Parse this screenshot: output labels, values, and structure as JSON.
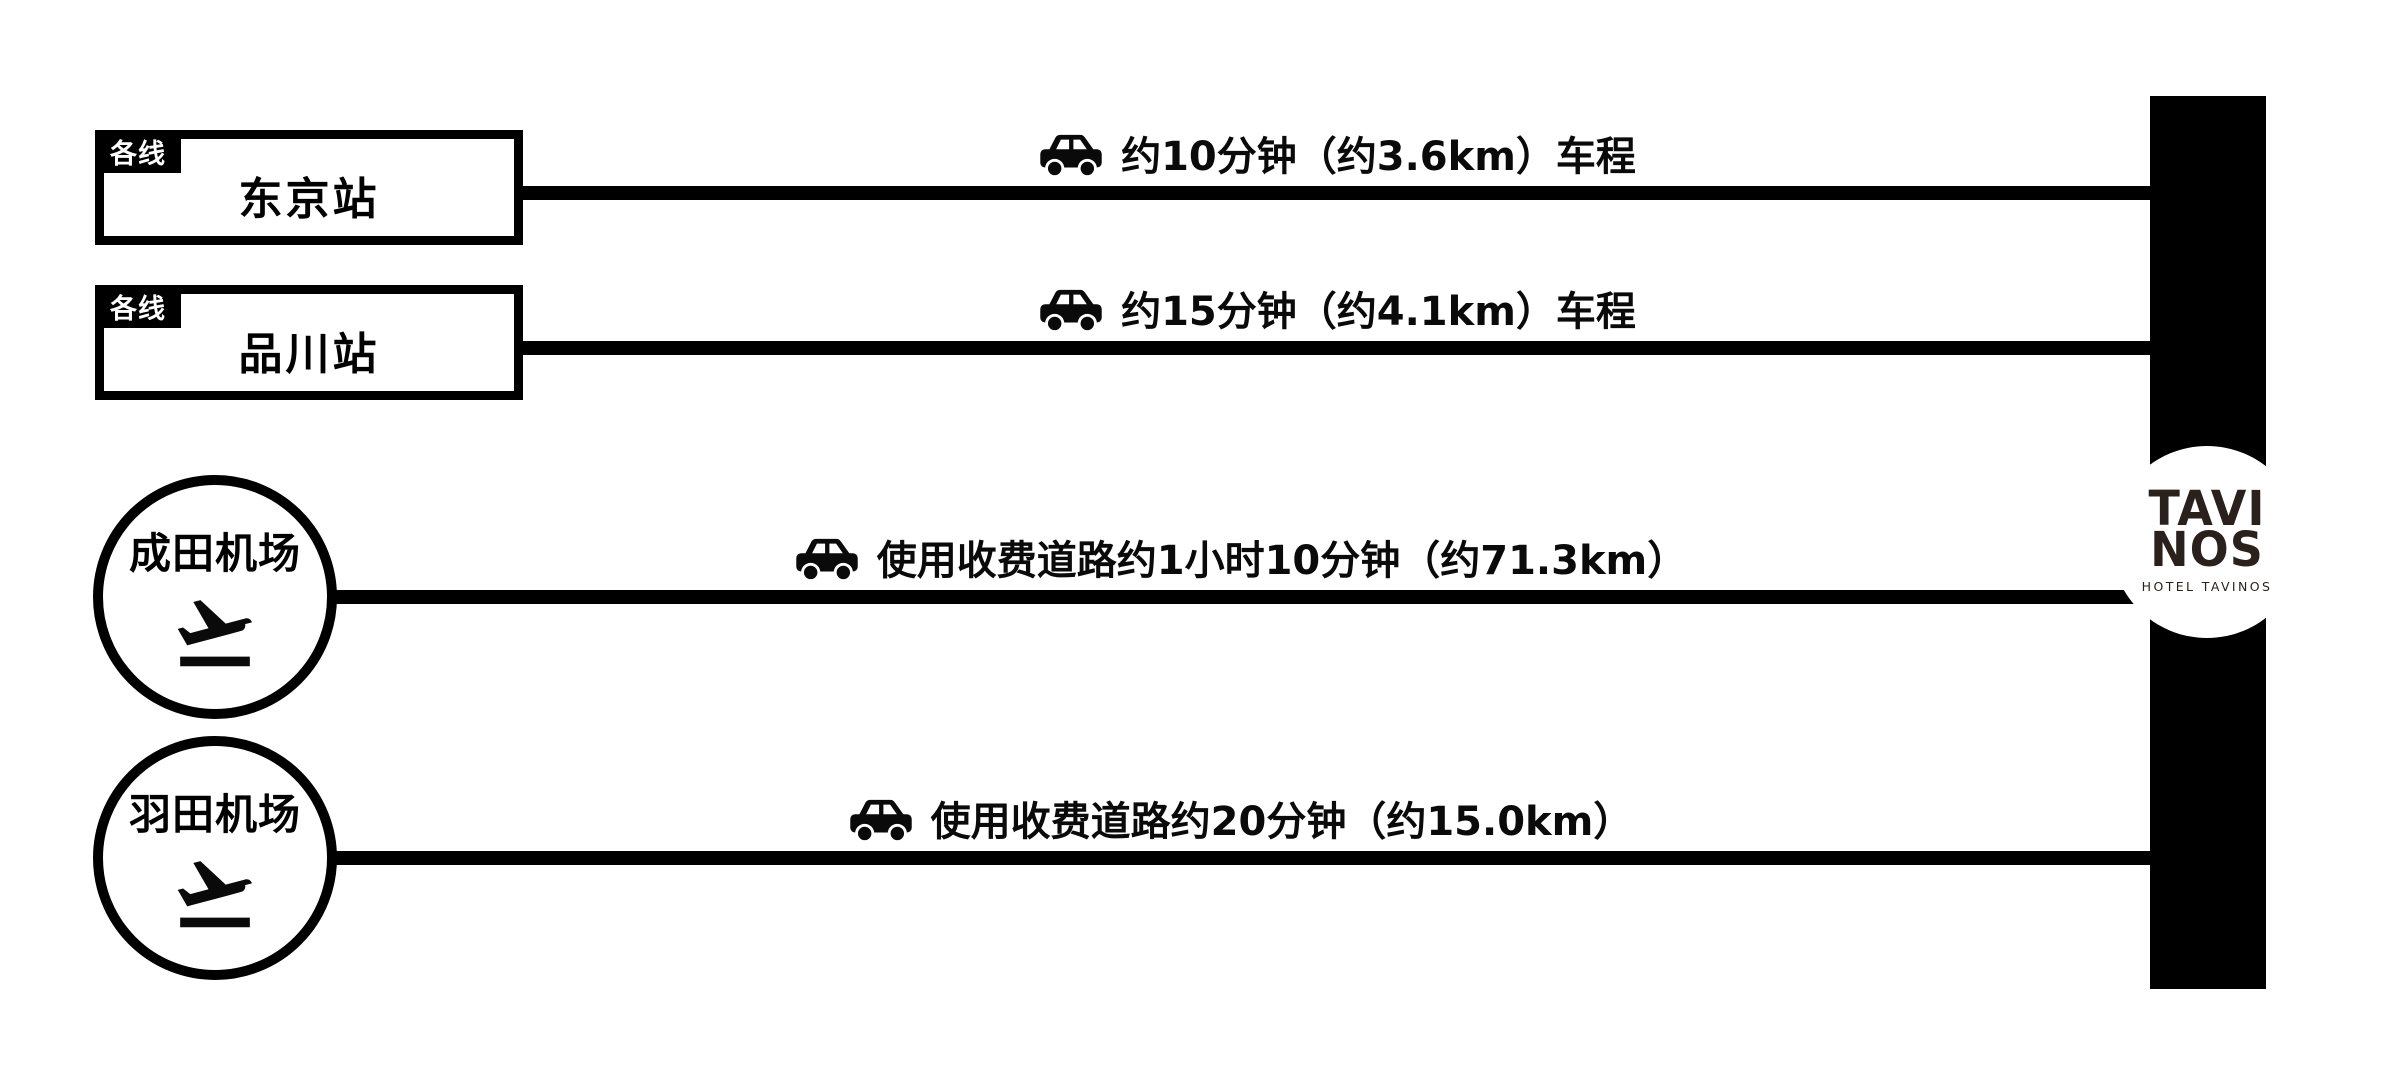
{
  "page": {
    "background": "#ffffff",
    "diagram_color": "#000000",
    "logo_color": "#2a211c"
  },
  "routes": [
    {
      "type": "station",
      "tag": "各线",
      "name": "东京站",
      "travel_label": "约10分钟（约3.6km）车程",
      "icon": "car-icon"
    },
    {
      "type": "station",
      "tag": "各线",
      "name": "品川站",
      "travel_label": "约15分钟（约4.1km）车程",
      "icon": "car-icon"
    },
    {
      "type": "airport",
      "name": "成田机场",
      "travel_label": "使用收费道路约1小时10分钟（约71.3km）",
      "icon": "car-icon",
      "badge_icon": "airplane-takeoff-icon"
    },
    {
      "type": "airport",
      "name": "羽田机场",
      "travel_label": "使用收费道路约20分钟（约15.0km）",
      "icon": "car-icon",
      "badge_icon": "airplane-takeoff-icon"
    }
  ],
  "destination": {
    "wordmark_top": "TAVI",
    "wordmark_bottom": "NOS",
    "subtitle": "HOTEL TAVINOS"
  }
}
